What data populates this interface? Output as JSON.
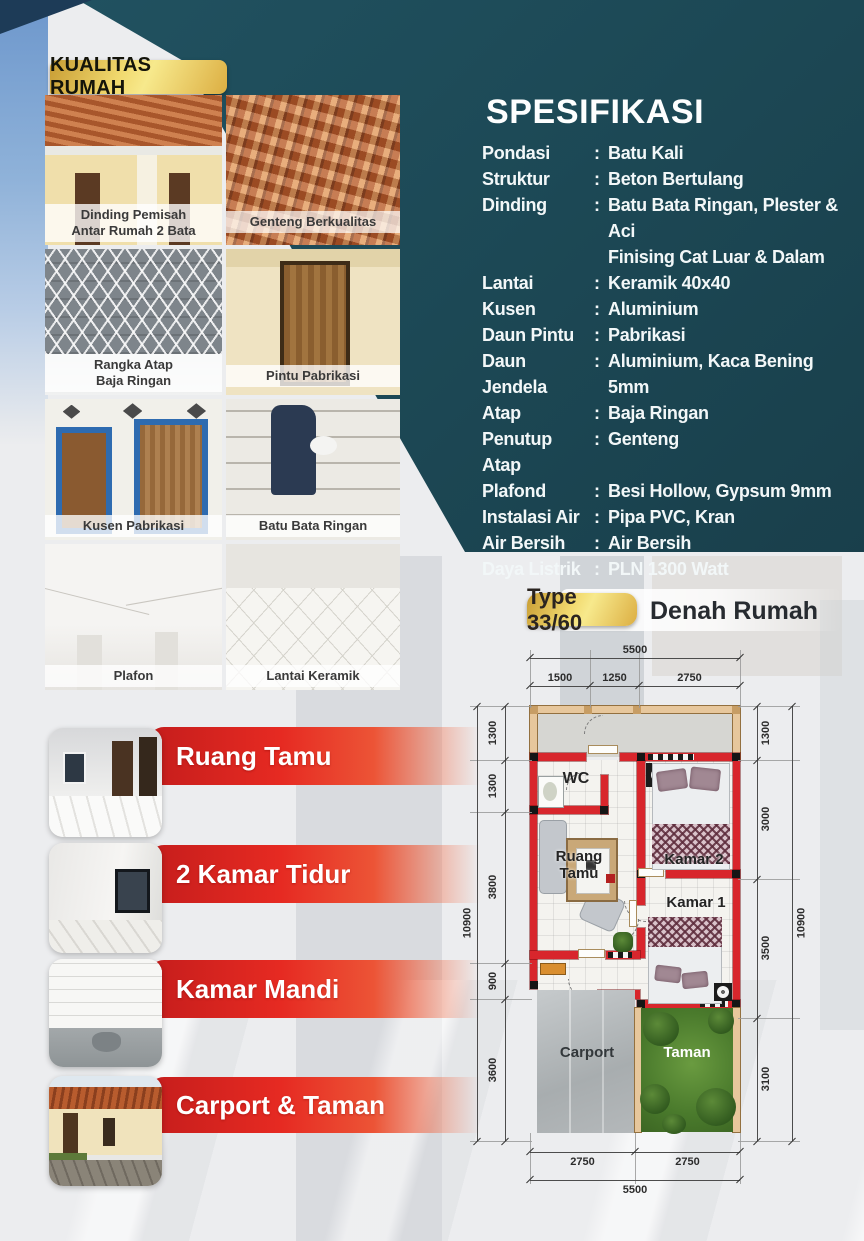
{
  "colors": {
    "teal": "#1d4a57",
    "navy": "#1d3b57",
    "gold": "#e8c452",
    "ribbon_red": "#e62a22",
    "wall_red": "#d8262c",
    "garden_green": "#55842f",
    "carport_gray": "#b9bec0"
  },
  "quality": {
    "badge": "KUALITAS RUMAH",
    "captions": [
      [
        "Dinding Pemisah",
        "Antar Rumah 2 Bata"
      ],
      [
        "Genteng Berkualitas"
      ],
      [
        "Rangka Atap",
        "Baja Ringan"
      ],
      [
        "Pintu Pabrikasi"
      ],
      [
        "Kusen Pabrikasi"
      ],
      [
        "Batu Bata Ringan"
      ],
      [
        "Plafon"
      ],
      [
        "Lantai Keramik"
      ]
    ]
  },
  "spec": {
    "title": "SPESIFIKASI",
    "rows": [
      {
        "label": "Pondasi",
        "value": "Batu Kali"
      },
      {
        "label": "Struktur",
        "value": "Beton Bertulang"
      },
      {
        "label": "Dinding",
        "value": "Batu Bata Ringan, Plester & Aci",
        "value2": "Finising Cat Luar & Dalam"
      },
      {
        "label": "Lantai",
        "value": "Keramik 40x40"
      },
      {
        "label": "Kusen",
        "value": "Aluminium"
      },
      {
        "label": "Daun Pintu",
        "value": "Pabrikasi"
      },
      {
        "label": "Daun Jendela",
        "value": "Aluminium, Kaca Bening 5mm"
      },
      {
        "label": "Atap",
        "value": "Baja Ringan"
      },
      {
        "label": "Penutup Atap",
        "value": "Genteng"
      },
      {
        "label": "Plafond",
        "value": "Besi Hollow, Gypsum 9mm"
      },
      {
        "label": "Instalasi Air",
        "value": "Pipa PVC, Kran"
      },
      {
        "label": "Air Bersih",
        "value": "Air Bersih"
      },
      {
        "label": "Daya Listrik",
        "value": "PLN 1300 Watt"
      }
    ]
  },
  "features": [
    "Ruang Tamu",
    "2 Kamar Tidur",
    "Kamar Mandi",
    "Carport & Taman"
  ],
  "plan": {
    "type_badge": "Type 33/60",
    "title": "Denah Rumah",
    "rooms": {
      "wc": "WC",
      "living1": "Ruang",
      "living2": "Tamu",
      "bed2": "Kamar 2",
      "bed1": "Kamar 1",
      "carport": "Carport",
      "garden": "Taman"
    },
    "dims": {
      "top_total": "5500",
      "top": [
        "1500",
        "1250",
        "2750"
      ],
      "left": [
        "1300",
        "1300",
        "3800",
        "900",
        "3600"
      ],
      "left_total": "10900",
      "right": [
        "1300",
        "3000",
        "3500",
        "3100"
      ],
      "right_total": "10900",
      "bottom": [
        "2750",
        "2750"
      ],
      "bottom_total": "5500"
    }
  }
}
